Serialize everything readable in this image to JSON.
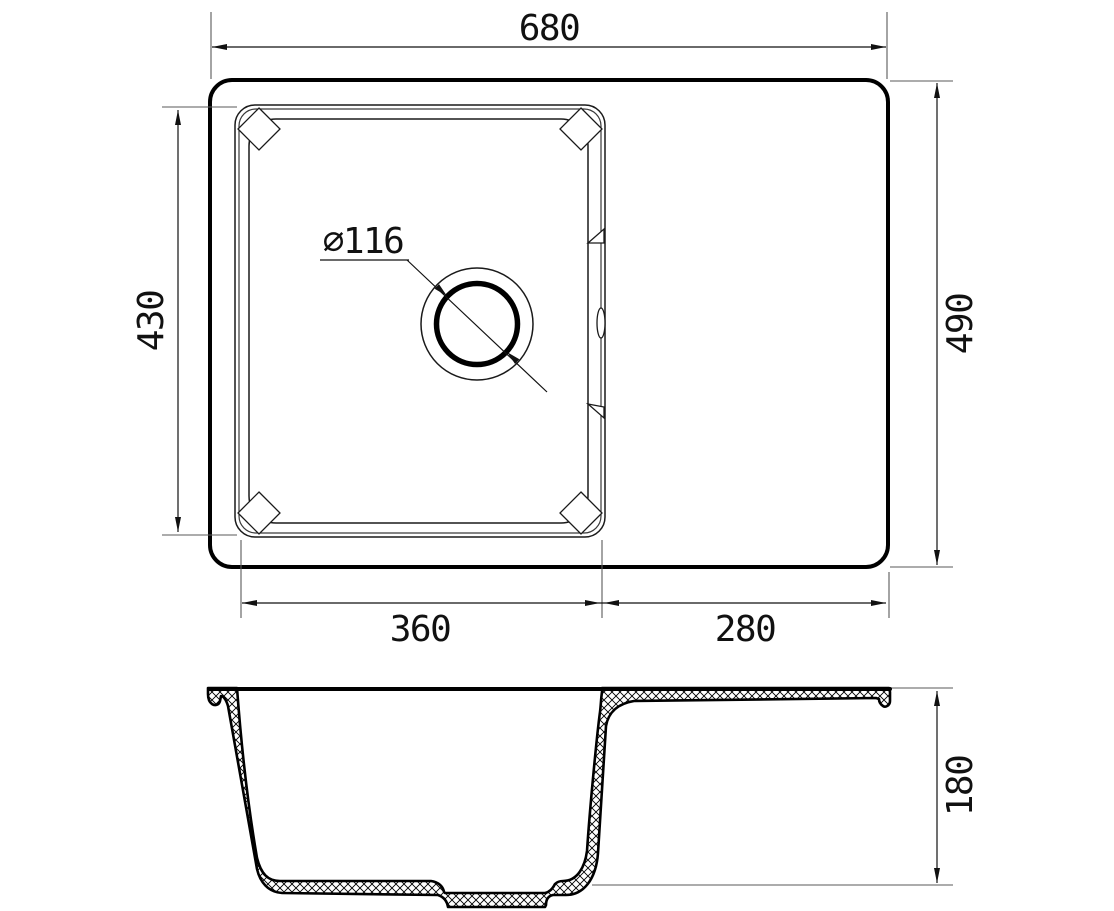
{
  "meta": {
    "ink_color": "#000000",
    "ext_line_color": "#5a5a5a",
    "background": "#ffffff"
  },
  "drawing": {
    "type": "technical-drawing",
    "subject": "kitchen sink with drainboard, top view and sectional side view",
    "dimensions": {
      "overall_width": "680",
      "overall_depth": "490",
      "bowl_length": "430",
      "bowl_width": "360",
      "drainboard_width": "280",
      "drain_diameter": "⌀116",
      "bowl_depth": "180"
    }
  }
}
